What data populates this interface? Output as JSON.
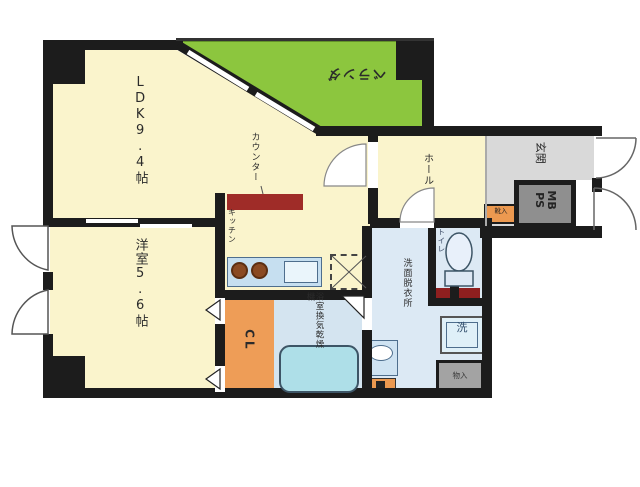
{
  "type": "apartment-floor-plan",
  "rooms": {
    "ldk": {
      "label": "LDK9.4帖"
    },
    "bedroom": {
      "label": "洋室5.6帖"
    },
    "veranda": {
      "label": "ベランダ"
    },
    "hall": {
      "label": "ホール"
    },
    "entrance": {
      "label": "玄関"
    },
    "kitchen": {
      "label": "キッチン"
    },
    "counter": {
      "label": "カウンター"
    },
    "closet": {
      "label": "CL"
    },
    "toilet": {
      "label": "トイレ"
    },
    "washroom": {
      "label": "洗面脱衣所"
    },
    "bathroom": {
      "label": "浴室換気乾燥機"
    },
    "meter_box": {
      "line1": "MB",
      "line2": "PS"
    },
    "laundry": {
      "label": "洗"
    },
    "storage": {
      "label": "物入"
    },
    "shoe_box": {
      "label": "靴入"
    }
  },
  "colors": {
    "wall": "#1c1c1c",
    "room_cream": "#faf4cc",
    "veranda_green": "#8cc63e",
    "water_blue": "#dce9f4",
    "closet_orange": "#ee9d57",
    "counter_red": "#9f2c28",
    "entrance_gray": "#d9d9d9",
    "meter_gray": "#8f8f8f",
    "tub_cyan": "#aedfe8"
  }
}
